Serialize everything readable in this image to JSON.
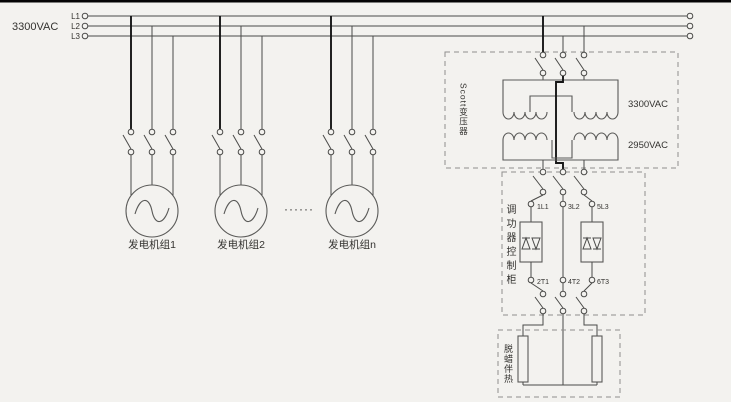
{
  "bus": {
    "voltage_label": "3300VAC",
    "phase_labels": [
      "L1",
      "L2",
      "L3"
    ]
  },
  "generators": {
    "unit_labels": [
      "发电机组1",
      "发电机组2",
      "发电机组n"
    ],
    "ellipsis": "······"
  },
  "scott_transformer": {
    "name_label": "Scott变压器",
    "primary_voltage_label": "3300VAC",
    "secondary_voltage_label": "2950VAC"
  },
  "power_controller": {
    "name_label": "调功器控制柜",
    "input_terminal_labels": [
      "1L1",
      "3L2",
      "5L3"
    ],
    "output_terminal_labels": [
      "2T1",
      "4T2",
      "6T3"
    ]
  },
  "load": {
    "name_label": "脱蜡伴热"
  }
}
